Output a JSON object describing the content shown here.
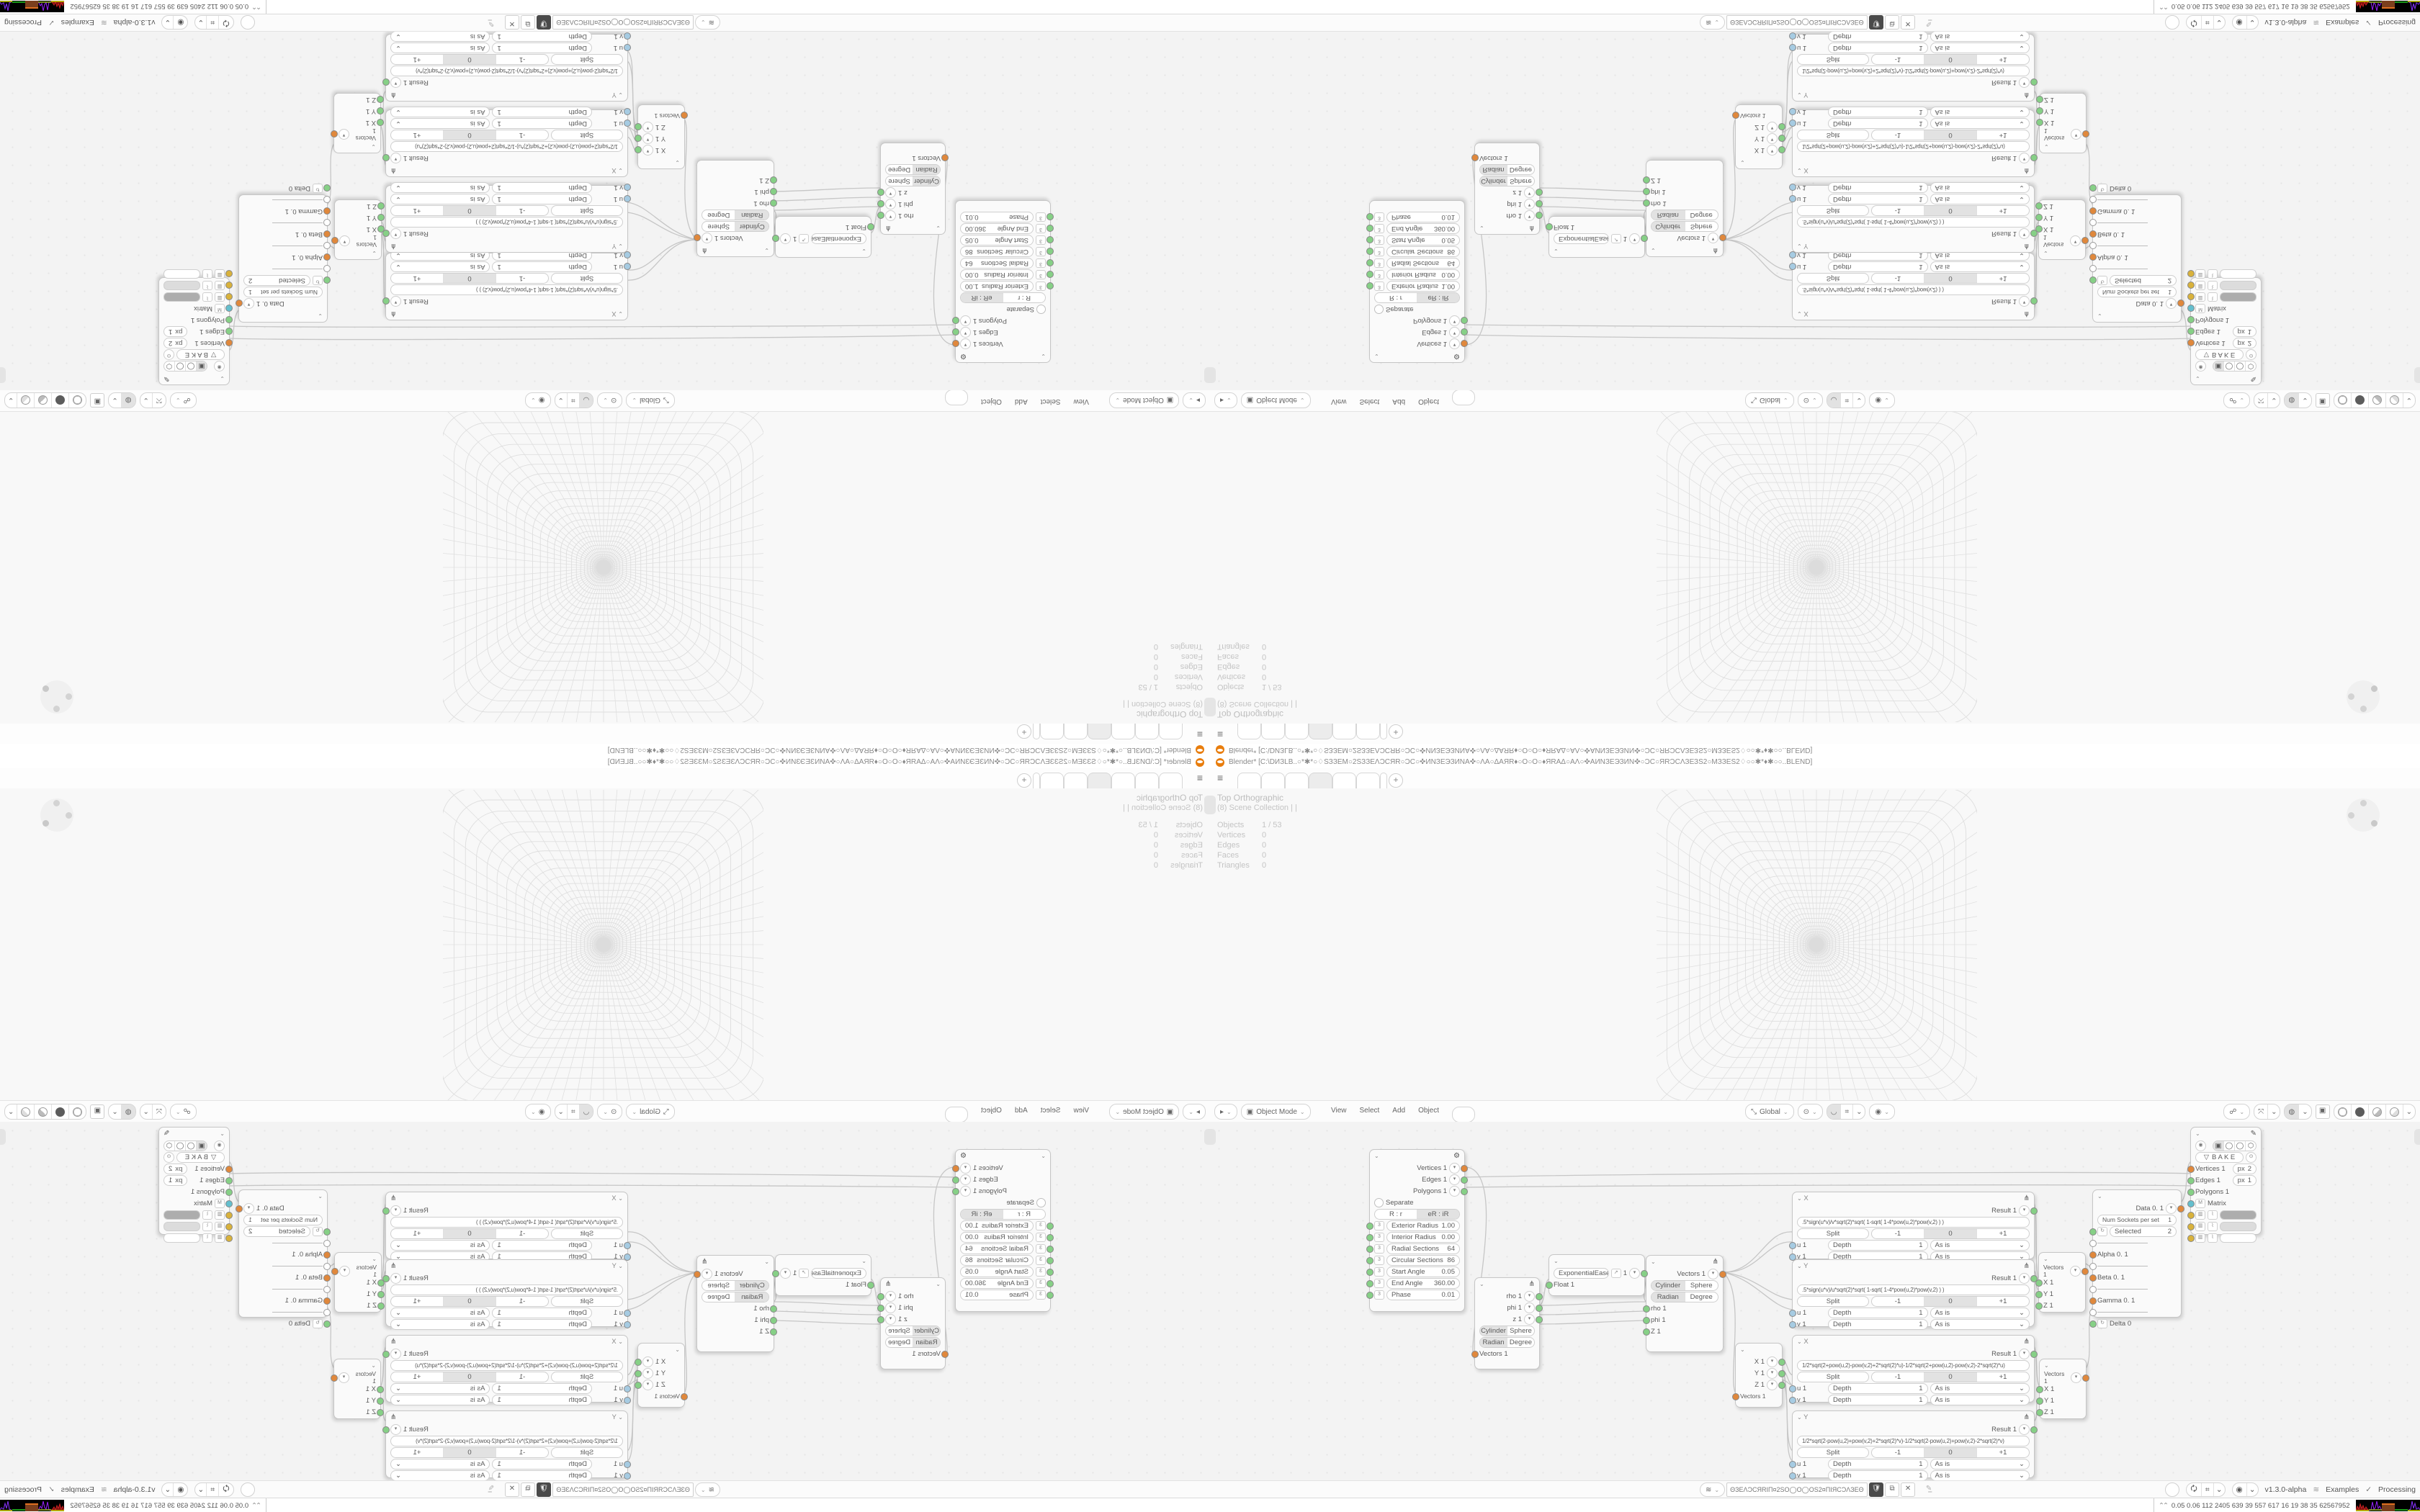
{
  "window_title": "Blender* [C:\\DИЗLB..○*✱*○♢SЗЗEM○2SЗЗEΛϽϹЯR○ϽϹ○✜ИNЗЕЭЗИNA✜○ΛA○ΔAЯR♦○Ο○Ο○♦ЯRAΔ○AΛ○✜AИNЗЕЭЗИN✜○ϽϹ○ЯRϽϹΛЗЕЗS2○MЗЗES2♢○○✱*♦✱○○..BLEND]",
  "viewport": {
    "view_label": "Top Orthographic",
    "collection": "(8) Scene Collection | |",
    "stats": [
      {
        "label": "Objects",
        "value": "1 / 53"
      },
      {
        "label": "Vertices",
        "value": "0"
      },
      {
        "label": "Edges",
        "value": "0"
      },
      {
        "label": "Faces",
        "value": "0"
      },
      {
        "label": "Triangles",
        "value": "0"
      }
    ]
  },
  "vp_header": {
    "mode": "Object Mode",
    "menus": [
      "View",
      "Select",
      "Add",
      "Object"
    ],
    "orientation": "Global"
  },
  "nodes": {
    "torus": {
      "outs": [
        "Vertices 1",
        "Edges 1",
        "Polygons 1"
      ],
      "separate": "Separate",
      "seg": [
        "R : r",
        "eR : iR"
      ],
      "fields": [
        {
          "label": "Exterior Radius",
          "value": "1.00"
        },
        {
          "label": "Interior Radius",
          "value": "0.00"
        },
        {
          "label": "Radial Sections",
          "value": "64"
        },
        {
          "label": "Circular Sections",
          "value": "86"
        },
        {
          "label": "Start Angle",
          "value": "0.05"
        },
        {
          "label": "End Angle",
          "value": "360.00"
        },
        {
          "label": "Phase",
          "value": "0.01"
        }
      ]
    },
    "polar_out": {
      "outs": [
        "rho 1",
        "phi 1",
        "z 1"
      ],
      "seg1": [
        "Cylinder",
        "Sphere"
      ],
      "seg2": [
        "Radian",
        "Degree"
      ],
      "input": "Vectors 1"
    },
    "easing": {
      "mode": "ExponentialEaseIn",
      "value": "1",
      "input": "Float 1"
    },
    "polar_in": {
      "out": "Vectors 1",
      "seg1": [
        "Cylinder",
        "Sphere"
      ],
      "seg2": [
        "Radian",
        "Degree"
      ],
      "ins": [
        "rho 1",
        "phi 1",
        "Z 1"
      ]
    },
    "formula_common": {
      "result": "Result 1",
      "split": "Split",
      "seg": [
        "-1",
        "0",
        "+1"
      ],
      "u": "u 1",
      "v": "v 1",
      "depth": "Depth",
      "depth_val": "1",
      "asis": "As is"
    },
    "formula": [
      {
        "title": "X",
        "expr": ".5*sign(u*v)/v*sqrt(2)*sqrt(   1-sqrt(   1-4*pow(u,2)*pow(v,2)   )   )"
      },
      {
        "title": "Y",
        "expr": ".5*sign(u*v)/u*sqrt(2)*sqrt(   1-sqrt(   1-4*pow(u,2)*pow(v,2)   )   )"
      },
      {
        "title": "X",
        "expr": "1/2*sqrt(2+pow(u,2)-pow(v,2)+2*sqrt(2)*u)-1/2*sqrt(2+pow(u,2)-pow(v,2)-2*sqrt(2)*u)"
      },
      {
        "title": "Y",
        "expr": "1/2*sqrt(2-pow(u,2)+pow(v,2)+2*sqrt(2)*v)-1/2*sqrt(2-pow(u,2)+pow(v,2)-2*sqrt(2)*v)"
      }
    ],
    "vec_out": {
      "outs": [
        "X 1",
        "Y 1",
        "Z 1"
      ],
      "input": "Vectors 1"
    },
    "vec_in": {
      "out": "Vectors 1",
      "ins": [
        "X 1",
        "Y 1",
        "Z 1"
      ]
    },
    "data": {
      "out": "Data 0. 1",
      "num_sockets_label": "Num Sockets per set",
      "num_sockets_value": "1",
      "selected_label": "Selected",
      "selected_value": "2",
      "items": [
        "Alpha 0. 1",
        "Beta 0. 1",
        "Gamma 0. 1"
      ],
      "delta": "Delta 0"
    },
    "viewer": {
      "bake": "B A K E",
      "rows": [
        "Vertices 1",
        "Edges 1",
        "Polygons 1",
        "Matrix"
      ],
      "px_label": "px",
      "px_verts": "2",
      "px_edges": "1",
      "swatches": [
        "#ADADAD",
        "#DCDCDC",
        "#FFFFFF"
      ]
    }
  },
  "ne_footer": {
    "tree_name": "ΘЗEΛϽϹЯRIΠ¤2SΟ◯Ο◯ΟS2¤ΠIЯϹϽΛЗEΘ",
    "version": "v1.3.0-alpha",
    "examples": "Examples",
    "processing": "Processing"
  },
  "status_bar": {
    "numbers": "0.05 0.06 112 2405 639 39 557 617 16 19 38 35 62567952"
  },
  "icons": {
    "hamburger": "≡",
    "add_tab": "+",
    "check": "✓",
    "dna": "≋",
    "gear": "⚙",
    "pencil": "✎",
    "formula_icon": "⋔",
    "chevron": "⌄",
    "collapse": "⌃"
  }
}
